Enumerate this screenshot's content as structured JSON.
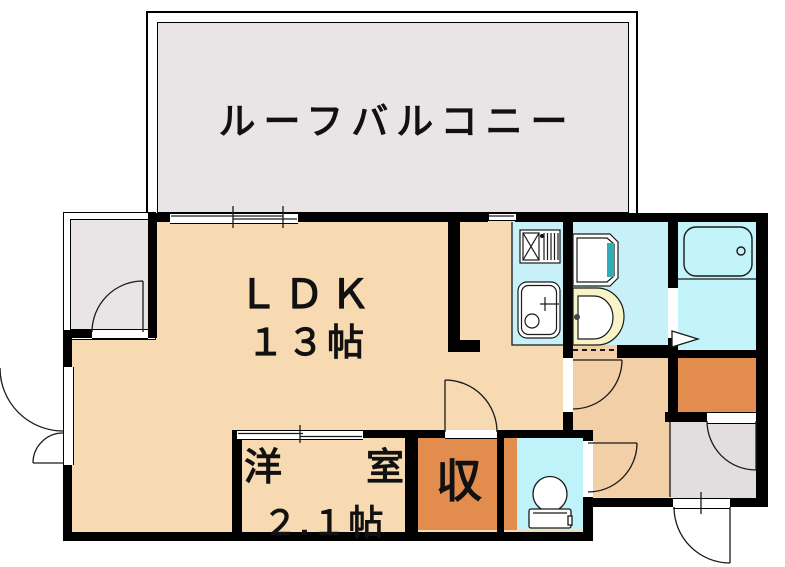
{
  "plan": {
    "type": "apartment-floor-plan",
    "rooms": {
      "roof_balcony": {
        "label": "ルーフバルコニー"
      },
      "ldk": {
        "label": "ＬＤＫ",
        "size": "１３帖"
      },
      "western_room": {
        "label_first": "洋",
        "label_second": "室",
        "size": "２.１帖"
      },
      "storage": {
        "label": "収"
      }
    },
    "fixtures": [
      "gas-stove",
      "kitchen-sink",
      "vanity-mirror",
      "washbasin",
      "bathtub",
      "toilet"
    ],
    "colors": {
      "floor_peach": "#F8DAB2",
      "hallway_tan": "#F3CFA8",
      "water_cyan": "#C8F0F8",
      "bath_cyan": "#C2F4F9",
      "storage_orange": "#E28C4D",
      "balcony_gray": "#E9E5E6",
      "entrance_gray": "#E2DEDF",
      "basin_yellow": "#F8F4C8",
      "vanity_teal": "#2FAFB5",
      "wall_black": "#000000"
    }
  }
}
